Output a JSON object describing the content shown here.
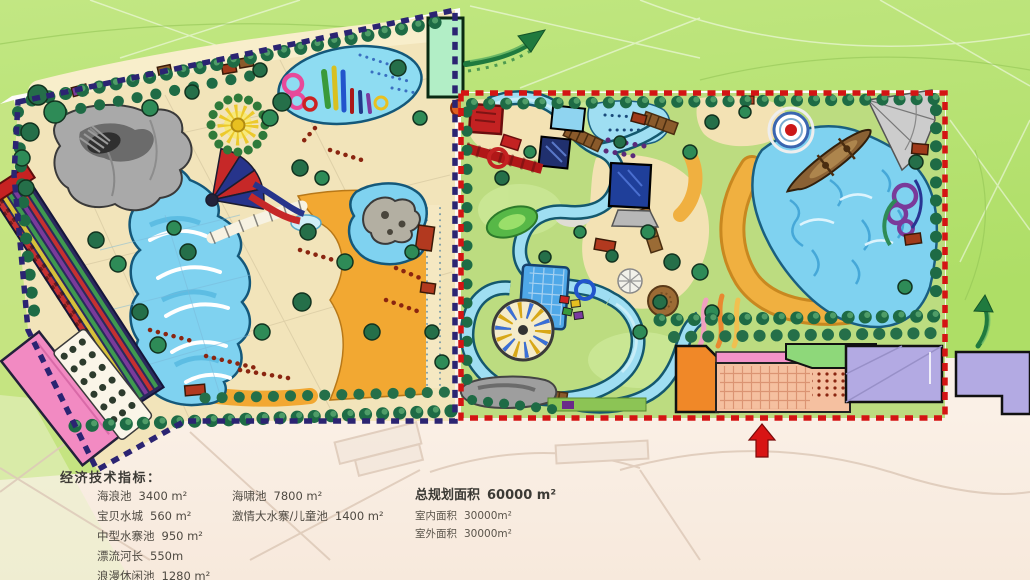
{
  "legend": {
    "title": "经济技术指标：",
    "col1": [
      {
        "label": "海浪池",
        "value": "3400 m²"
      },
      {
        "label": "宝贝水城",
        "value": "560 m²"
      },
      {
        "label": "中型水寨池",
        "value": "950 m²"
      },
      {
        "label": "漂流河长",
        "value": "550m"
      },
      {
        "label": "浪漫休闲池",
        "value": "1280 m²"
      }
    ],
    "col2": [
      {
        "label": "海啸池",
        "value": "7800 m²"
      },
      {
        "label": "激情大水寨/儿童池",
        "value": "1400 m²"
      }
    ],
    "col3": {
      "total": {
        "label": "总规划面积",
        "value": "60000 m²"
      },
      "indoor": {
        "label": "室内面积",
        "value": "30000m²"
      },
      "outdoor": {
        "label": "室外面积",
        "value": "30000m²"
      }
    }
  },
  "icons": {
    "entrance_arrow": "red-up-arrow",
    "flow_arrow_top": "green-curved-arrow",
    "flow_arrow_right": "green-curved-arrow"
  },
  "colors": {
    "boundary_zone_a": "#2b2472",
    "boundary_zone_b": "#d41414",
    "water": "#7fd2f0",
    "beach": "#f2a832",
    "lawn": "#bcdc80",
    "background_green": "#b7e172",
    "entrance_arrow": "#d81414",
    "exit_arrow": "#1f7a3e"
  }
}
